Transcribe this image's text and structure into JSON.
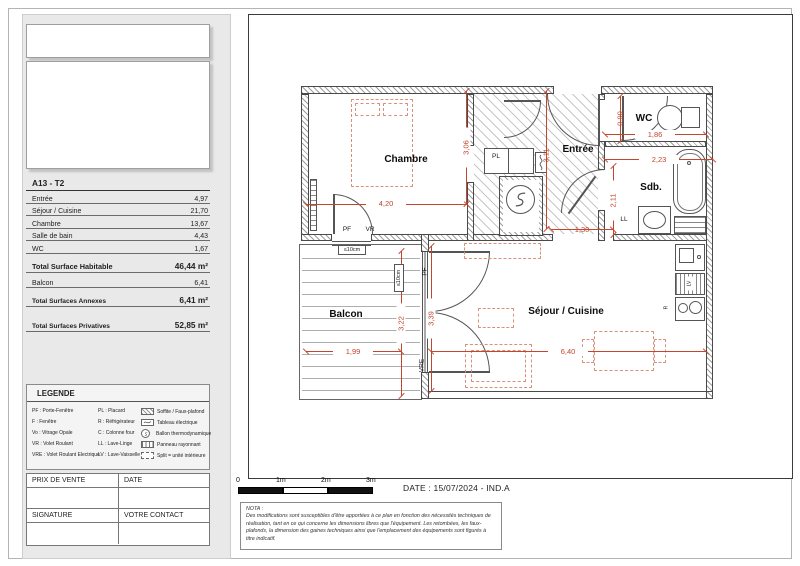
{
  "colors": {
    "dimension_red": "#c2462e",
    "furniture_salmon": "#d99079",
    "panel_gray": "#e9e9e9"
  },
  "sidebar": {
    "unit_title": "A13 - T2",
    "area_rows": [
      {
        "label": "Entrée",
        "value": "4,97"
      },
      {
        "label": "Séjour / Cuisine",
        "value": "21,70"
      },
      {
        "label": "Chambre",
        "value": "13,67"
      },
      {
        "label": "Salle de bain",
        "value": "4,43"
      },
      {
        "label": "WC",
        "value": "1,67"
      }
    ],
    "total_habitable": {
      "label": "Total Surface Habitable",
      "value": "46,44 m²"
    },
    "balcon_row": {
      "label": "Balcon",
      "value": "6,41"
    },
    "total_annexes": {
      "label": "Total Surfaces Annexes",
      "value": "6,41 m²"
    },
    "total_privatives": {
      "label": "Total Surfaces Privatives",
      "value": "52,85 m²"
    },
    "legend": {
      "title": "LEGENDE",
      "col1": [
        "PF : Porte-Fenêtre",
        "F : Fenêtre",
        "Vo : Vitrage Opale",
        "VR : Volet Roulant",
        "VRE : Volet Roulant Electrique"
      ],
      "col2": [
        "PL : Placard",
        "R : Réfrigérateur",
        "C : Colonne four",
        "LL : Lave-Linge",
        "LV : Lave-Vaisselle"
      ],
      "col3": [
        "Soffite / Faux-plafond",
        "Tableau électrique",
        "Ballon thermodynamique",
        "Panneau rayonnant",
        "Split = unité intérieure"
      ]
    },
    "sale_box": {
      "prix": "PRIX DE VENTE",
      "date": "DATE",
      "signature": "SIGNATURE",
      "contact": "VOTRE CONTACT"
    }
  },
  "plan": {
    "rooms": [
      "Chambre",
      "Entrée",
      "WC",
      "Sdb.",
      "Séjour / Cuisine",
      "Balcon"
    ],
    "dims": [
      "4,20",
      "3,06",
      "3,11",
      "1,30",
      "0,90",
      "1,86",
      "2,23",
      "2,11",
      "3,39",
      "6,40",
      "3,22",
      "1,99"
    ],
    "tags": [
      "PF",
      "VR",
      "PL",
      "LL",
      "PF",
      "VRE",
      "≤10cm",
      "≤10cm",
      "R",
      "LV"
    ]
  },
  "footer": {
    "scale_labels": [
      "0",
      "1m",
      "2m",
      "3m"
    ],
    "date_line": "DATE : 15/07/2024 - IND.A",
    "nota_title": "NOTA :",
    "nota_body": "Des modifications sont susceptibles d'être apportées à ce plan en fonction des nécessités techniques de réalisation, tant en ce qui concerne les dimensions libres que l'équipement. Les retombées, les faux-plafonds, la dimension des gaines techniques ainsi que l'emplacement des équipements sont figurés à titre indicatif."
  }
}
